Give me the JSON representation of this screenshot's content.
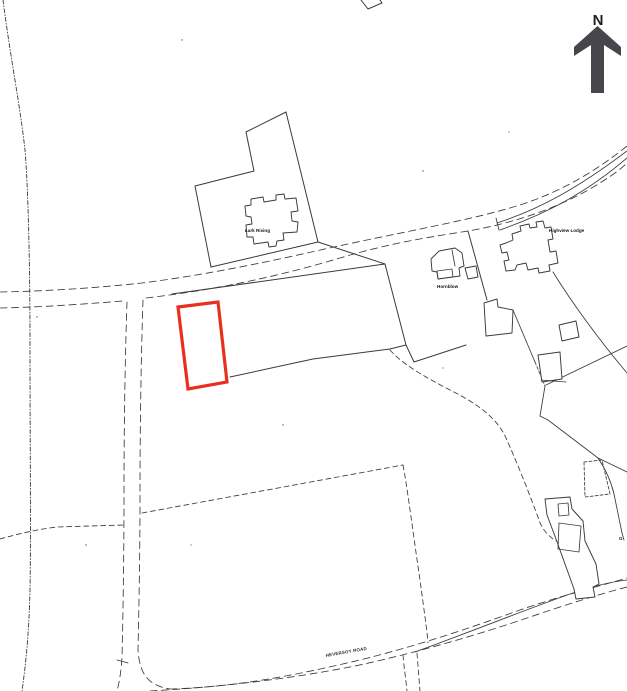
{
  "colors": {
    "line": "#3a3a3a",
    "site_outline": "#e7311e",
    "north_arrow": "#46464c",
    "label": "#141414"
  },
  "north": {
    "label": "N"
  },
  "labels": {
    "property_1": "Lark Rising",
    "property_2": "Hornblow",
    "property_3": "Highview Lodge",
    "road_name": "HEVERSOY ROAD",
    "edge_fragment": "G"
  }
}
